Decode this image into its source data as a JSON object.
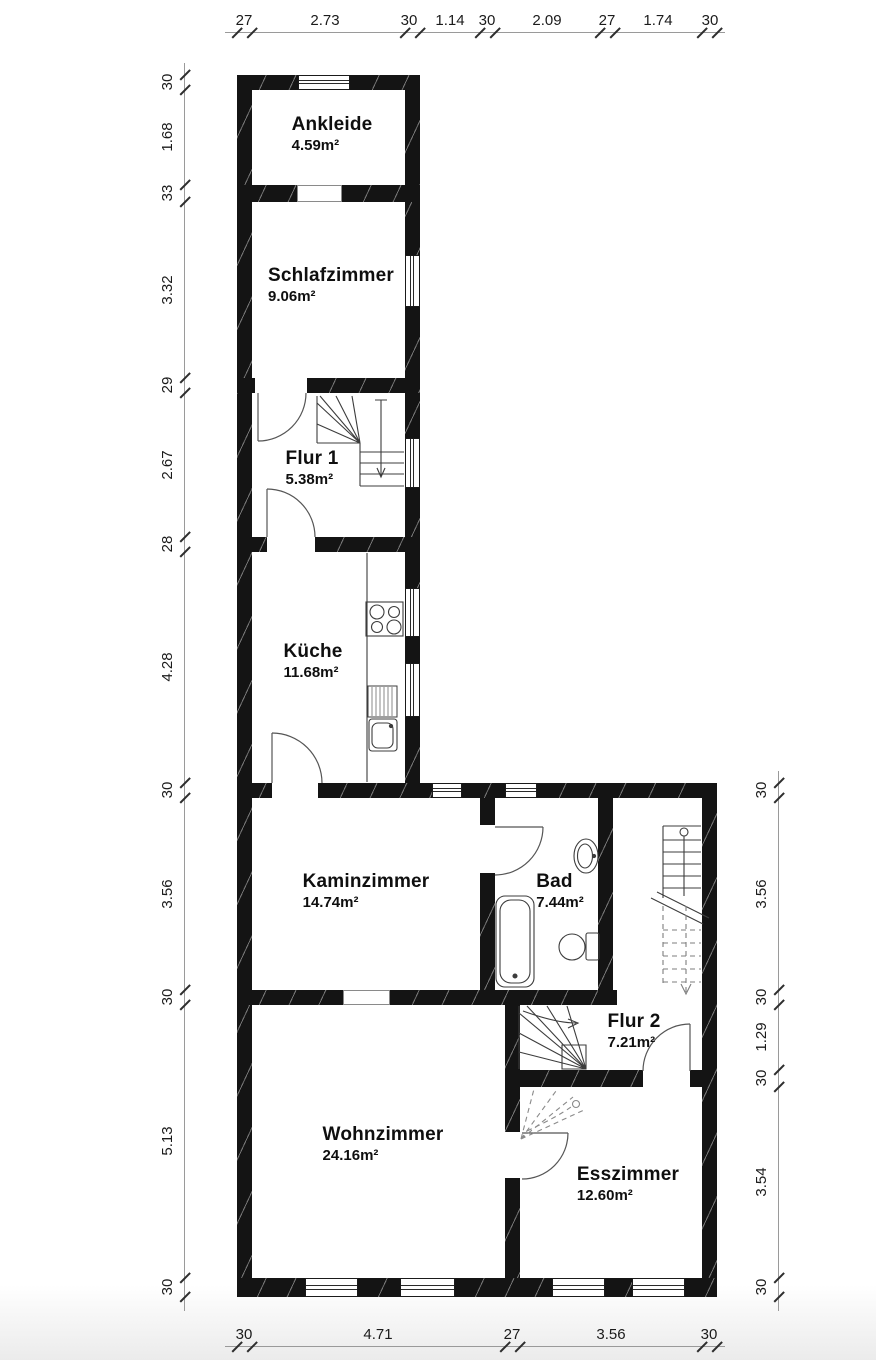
{
  "plan": {
    "rooms": [
      {
        "id": "ankleide",
        "name": "Ankleide",
        "area": "4.59m²"
      },
      {
        "id": "schlafzimmer",
        "name": "Schlafzimmer",
        "area": "9.06m²"
      },
      {
        "id": "flur1",
        "name": "Flur 1",
        "area": "5.38m²"
      },
      {
        "id": "kueche",
        "name": "Küche",
        "area": "11.68m²"
      },
      {
        "id": "kaminzimmer",
        "name": "Kaminzimmer",
        "area": "14.74m²"
      },
      {
        "id": "bad",
        "name": "Bad",
        "area": "7.44m²"
      },
      {
        "id": "flur2",
        "name": "Flur 2",
        "area": "7.21m²"
      },
      {
        "id": "wohnzimmer",
        "name": "Wohnzimmer",
        "area": "24.16m²"
      },
      {
        "id": "esszimmer",
        "name": "Esszimmer",
        "area": "12.60m²"
      }
    ],
    "dimensions": {
      "top": [
        "27",
        "2.73",
        "30",
        "1.14",
        "30",
        "2.09",
        "27",
        "1.74",
        "30"
      ],
      "left": [
        "30",
        "1.68",
        "33",
        "3.32",
        "29",
        "2.67",
        "28",
        "4.28",
        "30",
        "3.56",
        "30",
        "5.13",
        "30"
      ],
      "right": [
        "30",
        "3.56",
        "30",
        "1.29",
        "30",
        "3.54",
        "30"
      ],
      "bottom": [
        "30",
        "4.71",
        "27",
        "3.56",
        "30"
      ]
    },
    "fixtures": [
      "stove",
      "kitchen-sink",
      "drainer",
      "bathtub",
      "washbasin",
      "toilet",
      "main-stairs",
      "winder-stairs-flur1",
      "winder-stairs-flur2",
      "winder-stairs-dashed"
    ],
    "colors": {
      "wall": "#141414",
      "line": "#3c3c3c",
      "dim_text": "#1b1b1b",
      "background": "#ffffff"
    }
  }
}
